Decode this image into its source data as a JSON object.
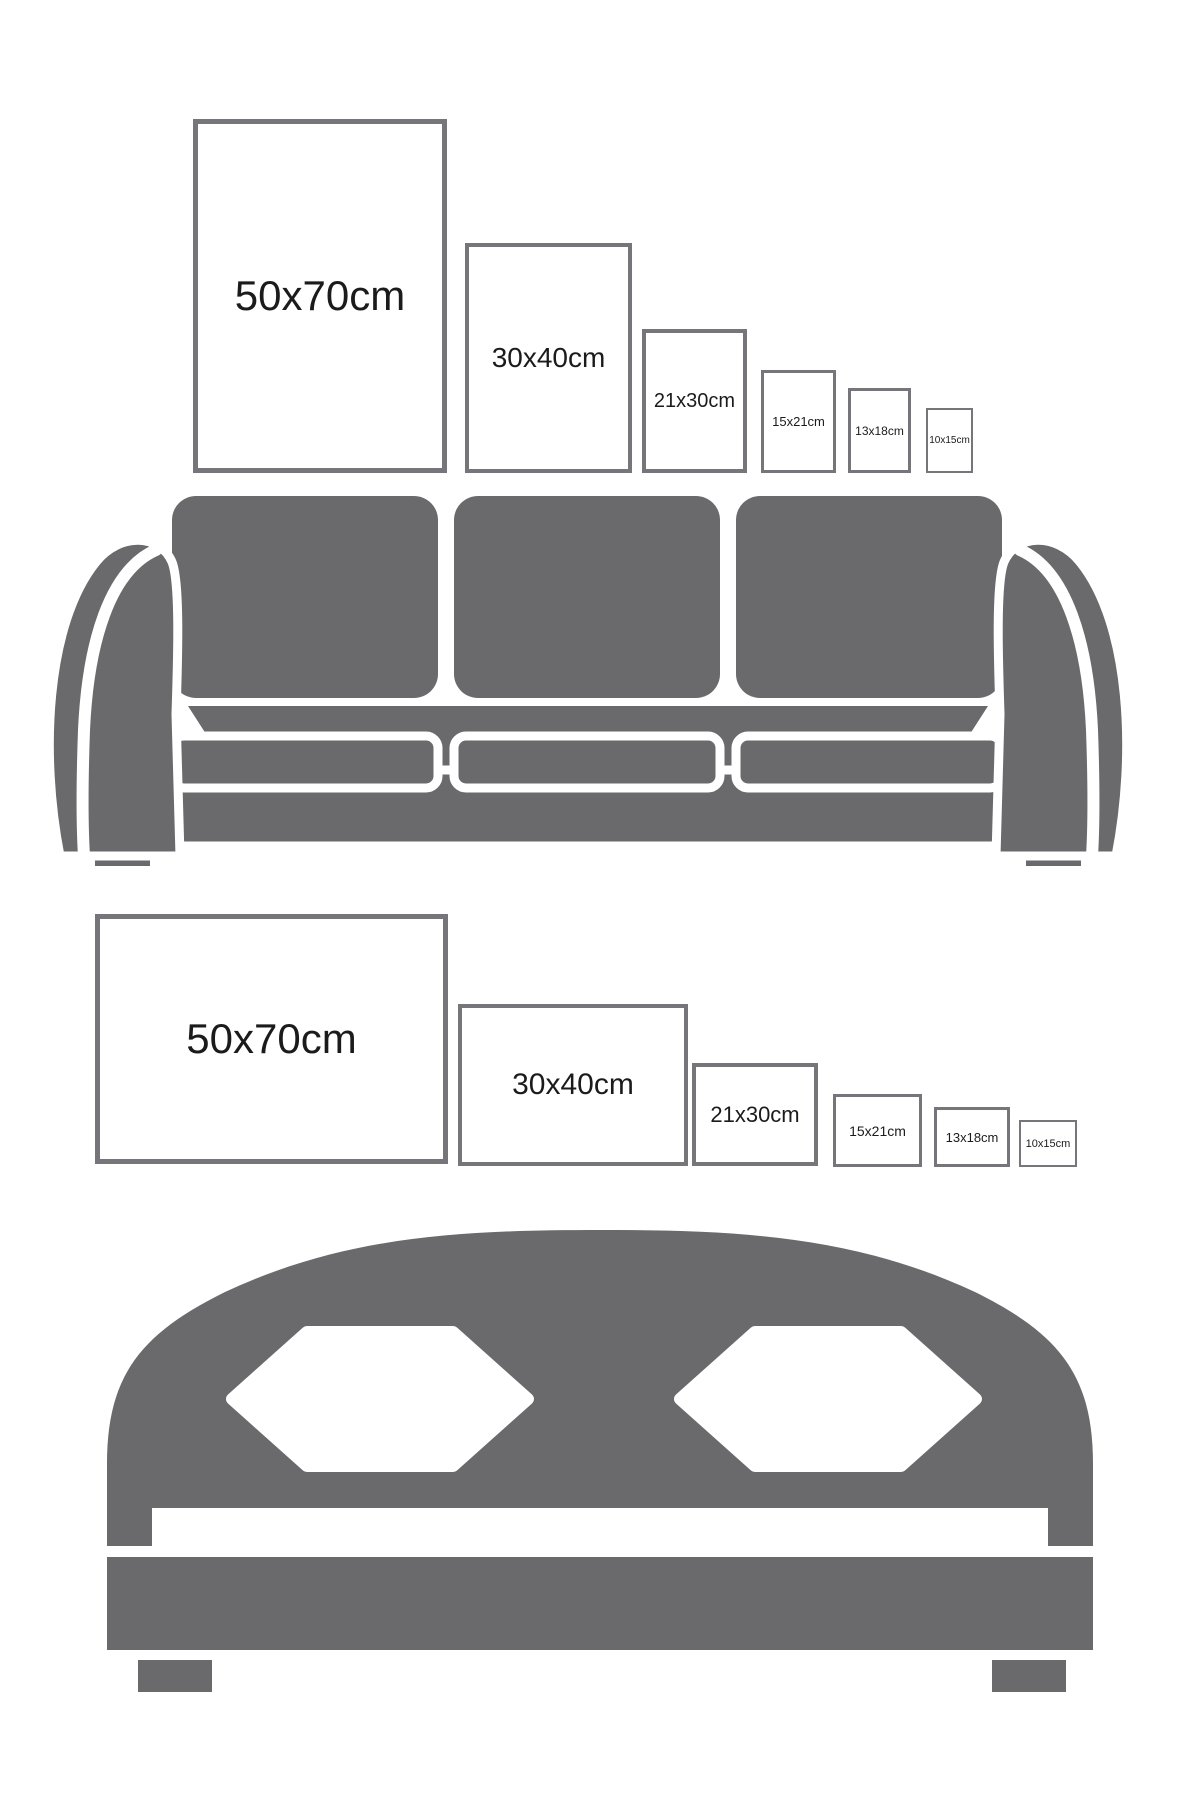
{
  "colors": {
    "background": "#ffffff",
    "furniture_gray": "#6a6a6d",
    "frame_border": "#76767a",
    "label_text": "#1b1b1b"
  },
  "sections": [
    {
      "id": "sofa-size-guide",
      "furniture": "sofa",
      "furniture_icon": "sofa-icon",
      "orientation": "portrait",
      "sizes": [
        {
          "label": "50x70cm"
        },
        {
          "label": "30x40cm"
        },
        {
          "label": "21x30cm"
        },
        {
          "label": "15x21cm"
        },
        {
          "label": "13x18cm"
        },
        {
          "label": "10x15cm"
        }
      ]
    },
    {
      "id": "bed-size-guide",
      "furniture": "bed",
      "furniture_icon": "bed-icon",
      "orientation": "landscape",
      "sizes": [
        {
          "label": "50x70cm"
        },
        {
          "label": "30x40cm"
        },
        {
          "label": "21x30cm"
        },
        {
          "label": "15x21cm"
        },
        {
          "label": "13x18cm"
        },
        {
          "label": "10x15cm"
        }
      ]
    }
  ]
}
